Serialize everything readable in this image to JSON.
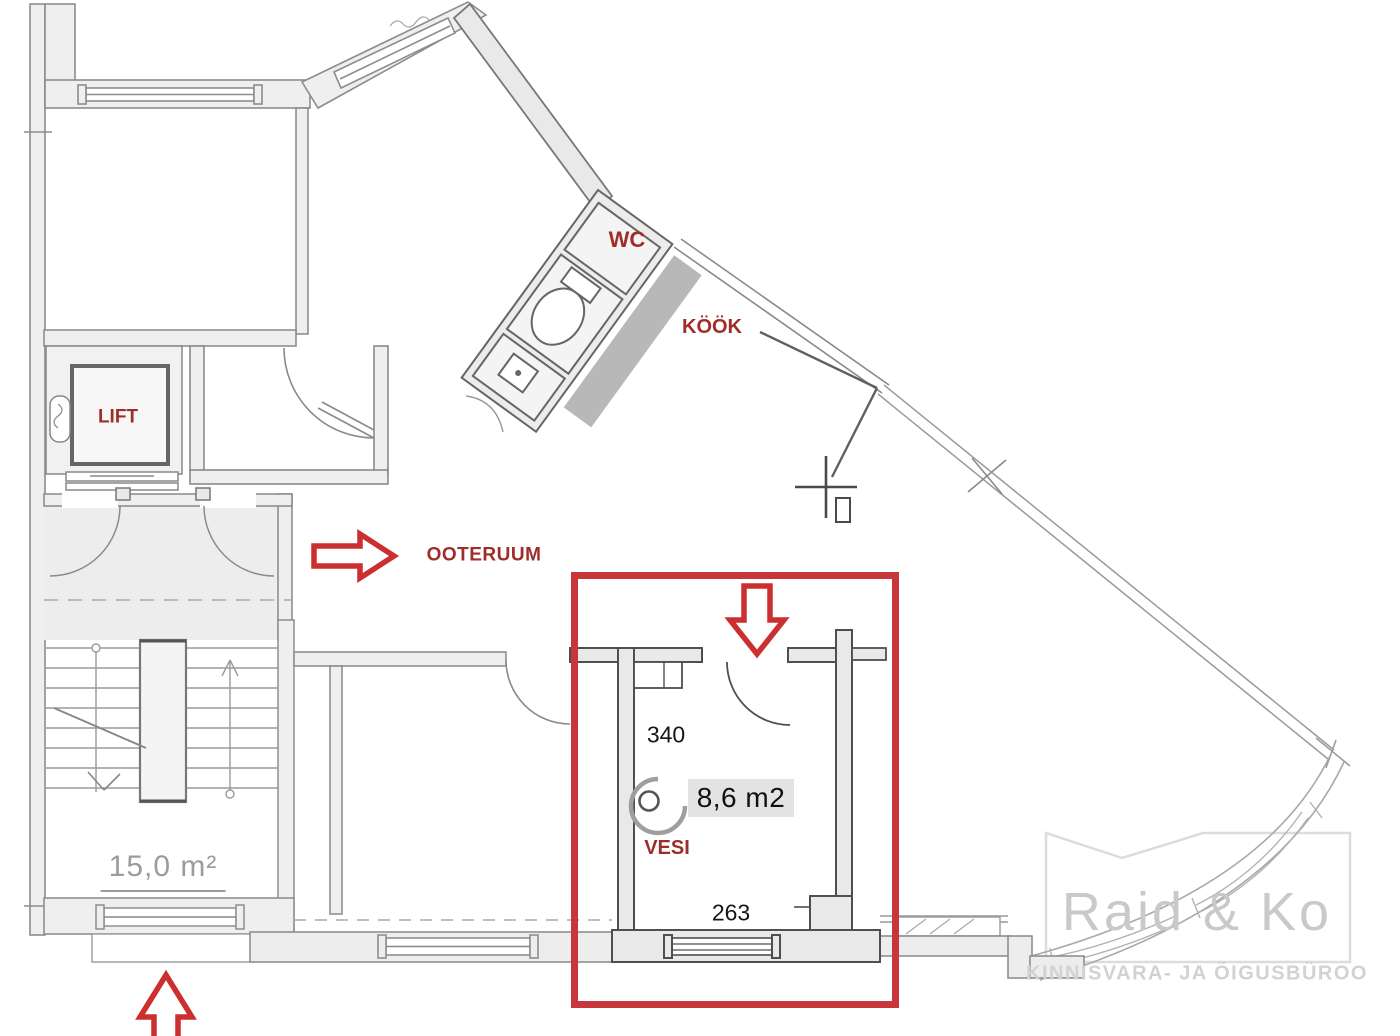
{
  "plan": {
    "rooms": {
      "wc": {
        "label": "WC"
      },
      "kitchen": {
        "label": "KÖÖK"
      },
      "lift": {
        "label": "LIFT"
      },
      "waiting_room": {
        "label": "OOTERUUM"
      },
      "water_point": {
        "label": "VESI"
      }
    },
    "highlighted_room": {
      "area_label": "8,6 m2",
      "width_top": "340",
      "width_bottom": "263"
    },
    "staircase": {
      "area_label": "15,0 m²"
    }
  },
  "annotations": {
    "arrows": [
      {
        "icon": "arrow-right-icon",
        "points_to": "OOTERUUM"
      },
      {
        "icon": "arrow-down-icon",
        "points_to": "highlighted room entrance"
      },
      {
        "icon": "arrow-up-icon",
        "points_to": "building entrance"
      }
    ],
    "colors": {
      "label_red": "#9f2d28",
      "arrow_red": "#cb2f2f",
      "highlight_box_red": "#c8353b"
    }
  },
  "watermark": {
    "brand": "Raid & Ko",
    "tagline": "KINNISVARA- JA ÕIGUSBÜROO"
  }
}
